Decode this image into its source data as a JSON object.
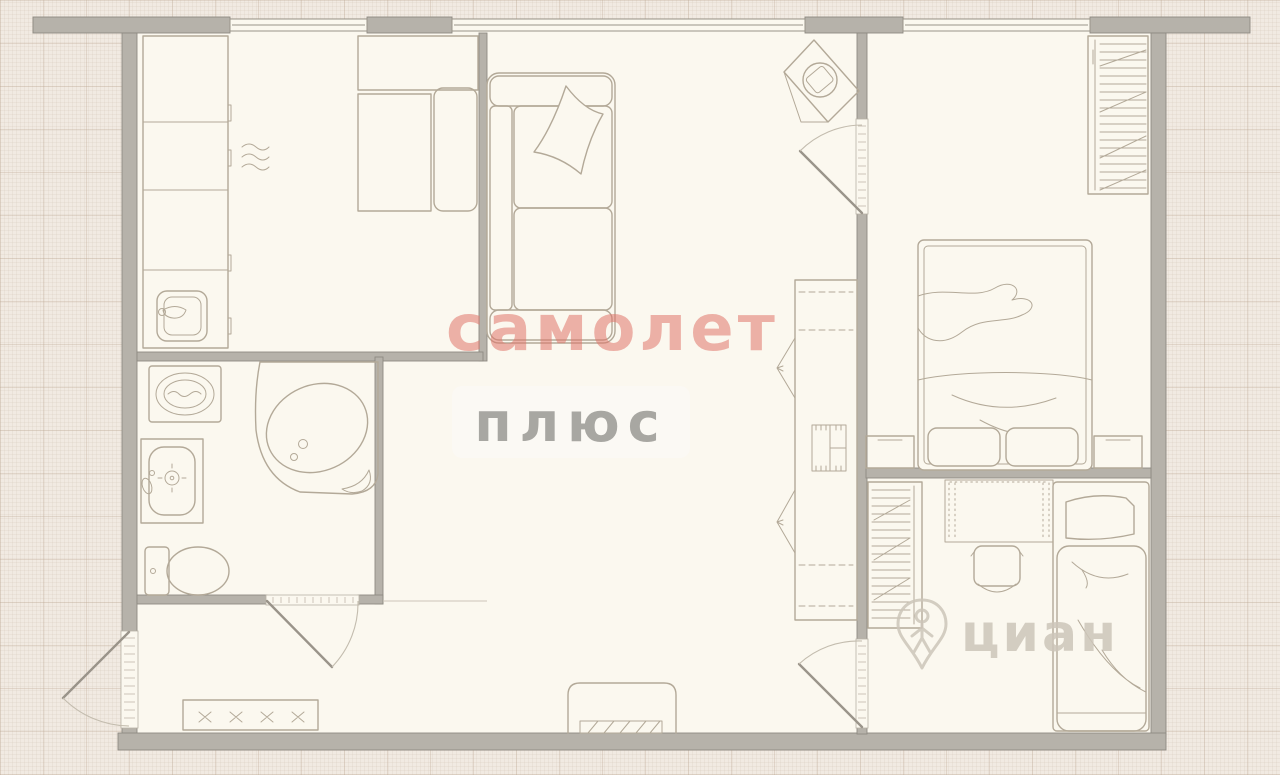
{
  "watermarks": {
    "brand_primary": "самолет",
    "brand_secondary": "плюс",
    "corner_brand": "циан"
  },
  "palette": {
    "background": "#f1eae2",
    "room_fill": "#fbf8ef",
    "wall_fill": "#b6b2aa",
    "wall_edge": "#8e8a82",
    "furniture_line": "#b3a998",
    "brand_primary_color": "#e17a6f",
    "brand_secondary_color": "#969490",
    "corner_brand_color": "#cdc6ba"
  },
  "plan": {
    "rooms": [
      {
        "name": "kitchen",
        "furniture": [
          "counter-cabinets",
          "kitchen-sink",
          "hob-steam",
          "wall-cabinet",
          "dining-table",
          "bench"
        ]
      },
      {
        "name": "living-room",
        "furniture": [
          "sofa",
          "pillow",
          "tv-stand",
          "corner-desk",
          "desk-chair",
          "shelving-unit"
        ]
      },
      {
        "name": "bathroom",
        "furniture": [
          "washing-machine",
          "corner-bathtub",
          "washbasin",
          "toilet"
        ]
      },
      {
        "name": "bedroom",
        "furniture": [
          "double-bed",
          "wardrobe",
          "nightstand-left",
          "nightstand-right"
        ]
      },
      {
        "name": "kids-room",
        "furniture": [
          "single-bed",
          "study-desk",
          "study-chair",
          "wardrobe"
        ]
      },
      {
        "name": "hallway",
        "furniture": [
          "shoe-cabinet",
          "entrance-door"
        ]
      }
    ]
  }
}
